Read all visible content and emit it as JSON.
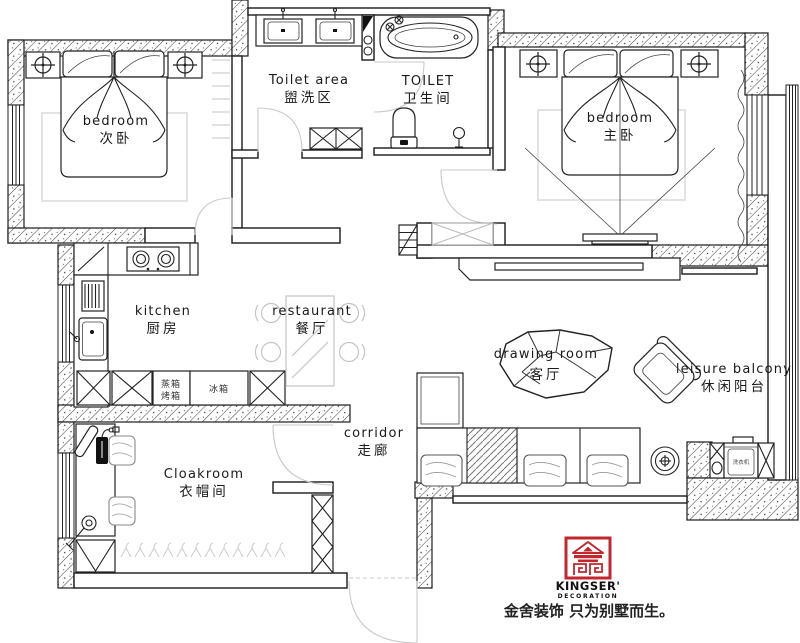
{
  "meta": {
    "type": "apartment floor plan"
  },
  "rooms": [
    {
      "id": "bedroom-secondary",
      "en": "bedroom",
      "zh": "次卧"
    },
    {
      "id": "toilet-area",
      "en": "Toilet area",
      "zh": "盥洗区"
    },
    {
      "id": "toilet",
      "en": "TOILET",
      "zh": "卫生间"
    },
    {
      "id": "bedroom-master",
      "en": "bedroom",
      "zh": "主卧"
    },
    {
      "id": "kitchen",
      "en": "kitchen",
      "zh": "厨房"
    },
    {
      "id": "restaurant",
      "en": "restaurant",
      "zh": "餐厅"
    },
    {
      "id": "corridor",
      "en": "corridor",
      "zh": "走廊"
    },
    {
      "id": "cloakroom",
      "en": "Cloakroom",
      "zh": "衣帽间"
    },
    {
      "id": "drawing-room",
      "en": "drawing room",
      "zh": "客厅"
    },
    {
      "id": "leisure-balcony",
      "en": "leisure balcony",
      "zh": "休闲阳台"
    }
  ],
  "appliances": {
    "steam_oven_line1": "蒸箱",
    "steam_oven_line2": "烤箱",
    "fridge": "冰箱",
    "washer": "洗衣机"
  },
  "branding": {
    "name": "KINGSER'",
    "subtitle": "DECORATION",
    "tagline": "金舍装饰 只为别墅而生。",
    "logo_color": "#C1272D"
  },
  "colors": {
    "wall_line": "#1a1a1a",
    "light_gray": "#c9c9c9",
    "logo_red": "#C1272D",
    "background": "#ffffff"
  }
}
